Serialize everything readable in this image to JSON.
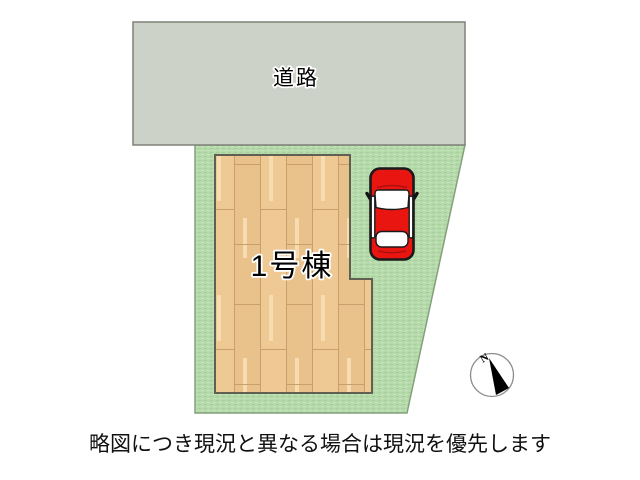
{
  "plan": {
    "road_label": "道路",
    "building_label": "1号棟",
    "compass_label": "N",
    "caption": "略図につき現況と異なる場合は現況を優先します"
  },
  "colors": {
    "background": "#ffffff",
    "road_fill": "#cdd2c9",
    "road_border": "#7f8278",
    "grass_base": "#b6daab",
    "grass_dark": "#a6cf9b",
    "grass_light": "#c5e5ba",
    "lot_border": "#84a07b",
    "wood_base": "#efc994",
    "wood_alt": "#e9c18b",
    "wood_line": "#c9a06b",
    "wood_streak": "#f7dcb2",
    "building_border": "#5f5f52",
    "car_body": "#e81511",
    "car_outline": "#1a1a1a",
    "car_window": "#ffffff",
    "compass_ring": "#8c8c8c",
    "compass_needle": "#000000",
    "caption_color": "#111111"
  }
}
